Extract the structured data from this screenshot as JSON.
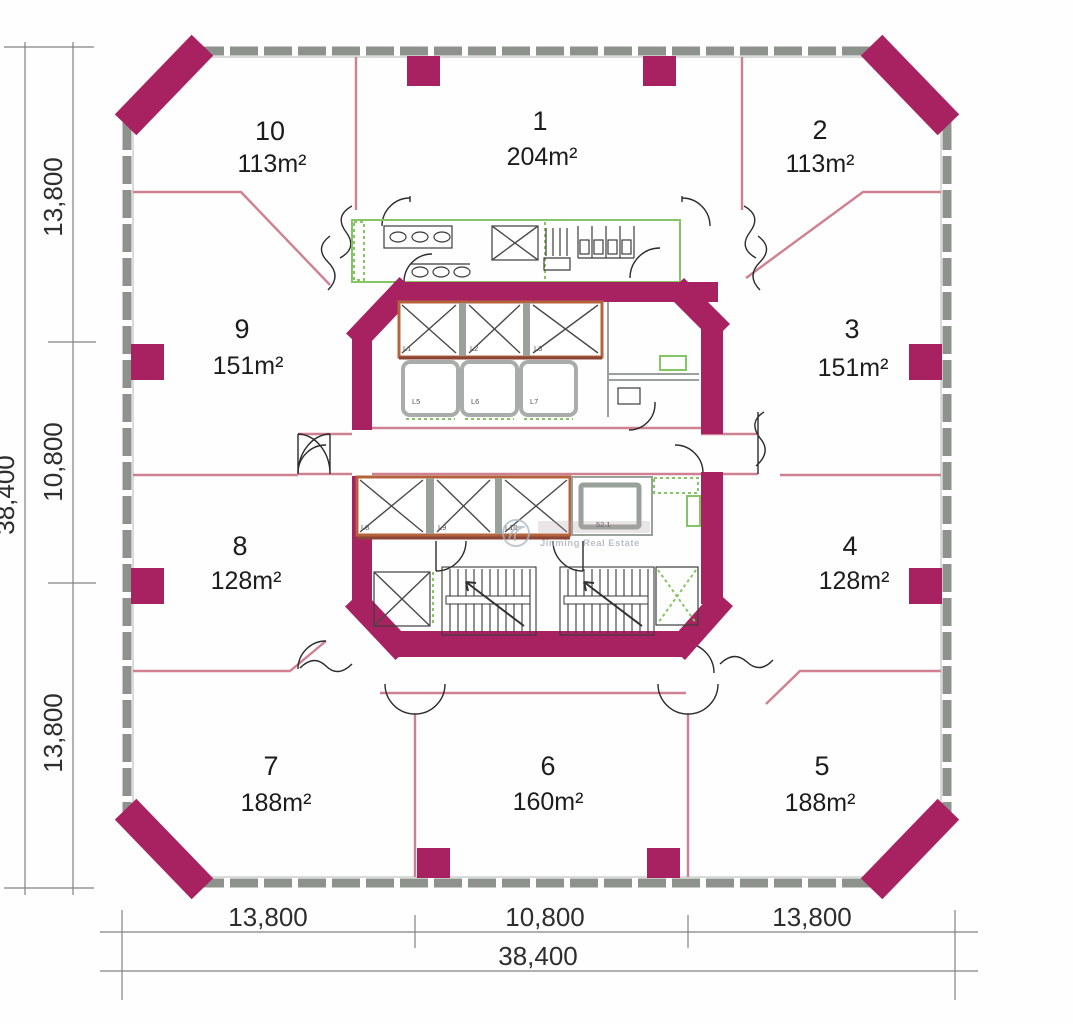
{
  "units": [
    {
      "number": "1",
      "area": "204m²"
    },
    {
      "number": "2",
      "area": "113m²"
    },
    {
      "number": "3",
      "area": "151m²"
    },
    {
      "number": "4",
      "area": "128m²"
    },
    {
      "number": "5",
      "area": "188m²"
    },
    {
      "number": "6",
      "area": "160m²"
    },
    {
      "number": "7",
      "area": "188m²"
    },
    {
      "number": "8",
      "area": "128m²"
    },
    {
      "number": "9",
      "area": "151m²"
    },
    {
      "number": "10",
      "area": "113m²"
    }
  ],
  "dimensions": {
    "left": {
      "segments": [
        "13,800",
        "10,800",
        "13,800"
      ],
      "total": "38,400"
    },
    "bottom": {
      "segments": [
        "13,800",
        "10,800",
        "13,800"
      ],
      "total": "38,400"
    }
  },
  "core": {
    "upper_shaft_labels": [
      "L1",
      "L2",
      "L3"
    ],
    "elevator_car_labels": [
      "L5",
      "L6",
      "L7"
    ],
    "lower_shaft_labels": [
      "L8",
      "L9",
      "L10"
    ],
    "machine_room_label": "52.1"
  },
  "watermark": {
    "text": "Jinming Real Estate"
  },
  "colors": {
    "wall": "#a82261",
    "partition": "#cf8191",
    "curtain": "#8e928d",
    "accent_orange": "#c9803a",
    "elevator_border": "#b5633c",
    "green": "#86c564",
    "dim_line": "#828282",
    "text": "#1c1c1c",
    "watermark": "#98a4ad"
  }
}
